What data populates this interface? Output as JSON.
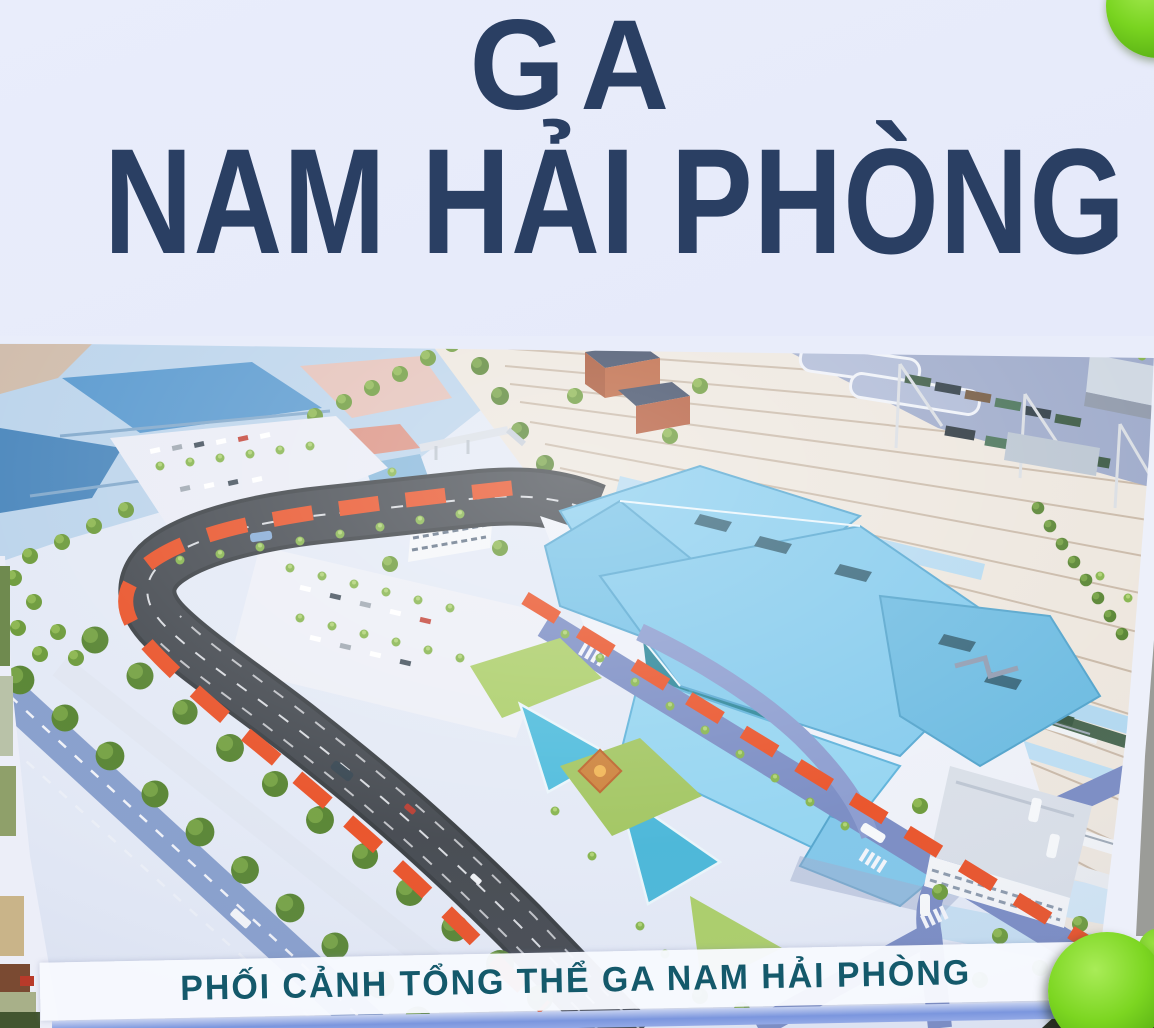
{
  "poster": {
    "title": {
      "line1": "GA",
      "line2": "NAM HẢI PHÒNG"
    },
    "caption": "PHỐI CẢNH TỔNG THỂ GA NAM HẢI PHÒNG",
    "colors": {
      "title_text": "#2a3f63",
      "caption_text": "#14596b",
      "paper": "#e9edfb",
      "station_roof_blue": "#7cc7ec",
      "boundary_dash_red": "#e8481c",
      "magnet_green": "#74d31d",
      "road_asphalt": "#3a3f46",
      "plaza_road_blue": "#7285c0",
      "tree_green": "#63942e"
    }
  }
}
